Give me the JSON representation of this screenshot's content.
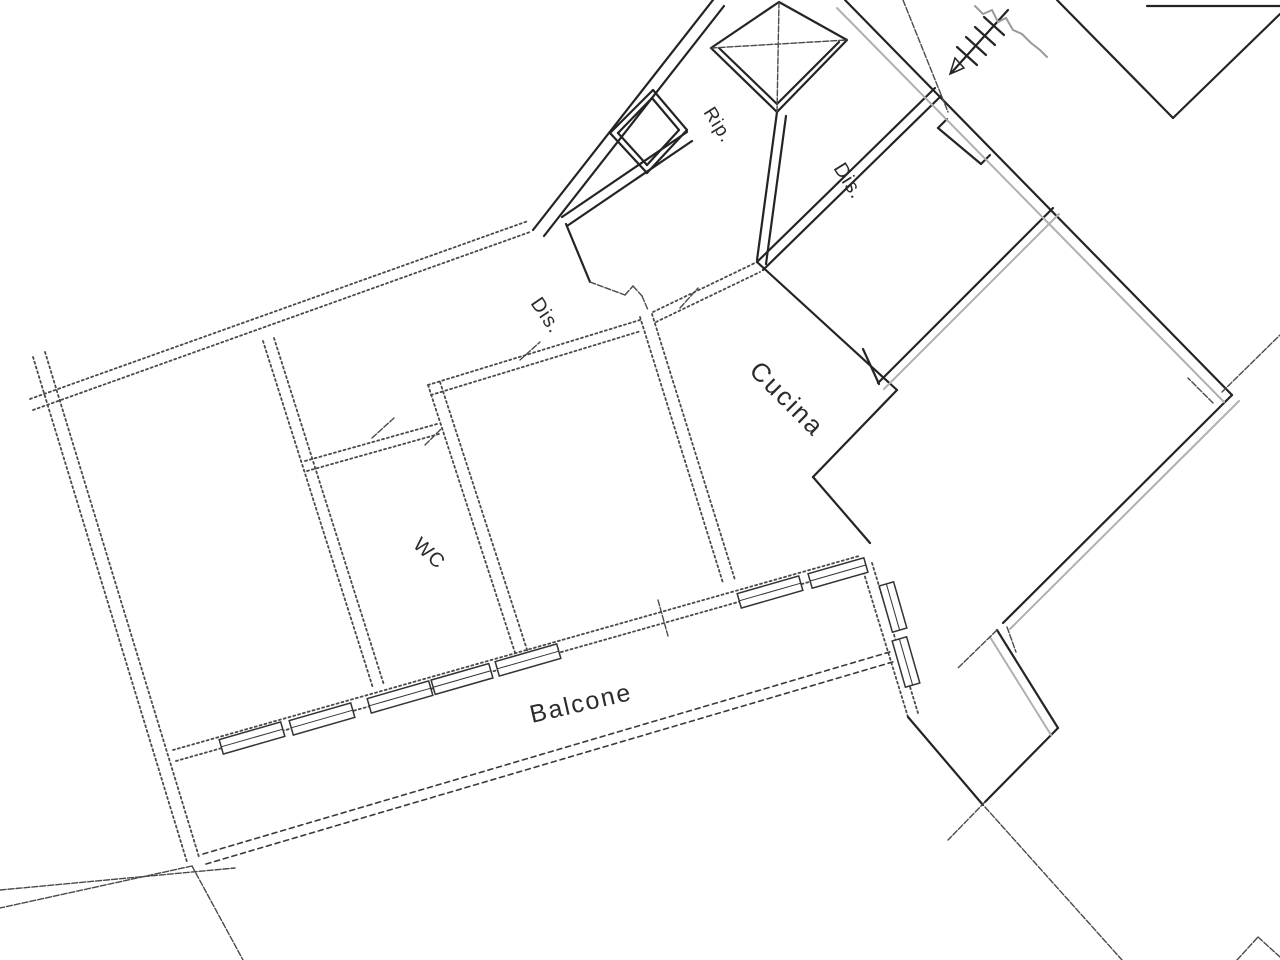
{
  "document": {
    "type": "scanned-floor-plan",
    "background_color": "#ffffff",
    "ink_color": "#242424",
    "faded_ink_color": "#4a4a4a",
    "gray_line_color": "#b0b0b0"
  },
  "labels": {
    "rip": {
      "text": "Rip.",
      "transform": "translate(703,112) rotate(58)"
    },
    "dis_landing": {
      "text": "Dis.",
      "transform": "translate(833,168) rotate(58)"
    },
    "dis_corridor": {
      "text": "Dis.",
      "transform": "translate(530,303) rotate(56)"
    },
    "cucina": {
      "text": "Cucina",
      "transform": "translate(748,372) rotate(45)"
    },
    "wc": {
      "text": "WC",
      "transform": "translate(412,546) rotate(43)"
    },
    "balcone": {
      "text": "Balcone",
      "transform": "translate(532,723) rotate(-13)"
    }
  },
  "segments": {
    "apartment-exterior-walls": {
      "style": "dashed",
      "lines": [
        [
          33,
          357,
          187,
          862
        ],
        [
          45,
          352,
          199,
          857
        ],
        [
          30,
          399,
          528,
          221
        ],
        [
          33,
          410,
          530,
          232
        ],
        [
          176,
          761,
          862,
          567
        ],
        [
          173,
          750,
          859,
          556
        ],
        [
          862,
          567,
          908,
          717
        ],
        [
          872,
          563,
          918,
          713
        ]
      ]
    },
    "apartment-partitions": {
      "style": "dashed",
      "lines": [
        [
          263,
          341,
          373,
          688
        ],
        [
          274,
          338,
          384,
          685
        ],
        [
          305,
          461,
          437,
          424
        ],
        [
          307,
          471,
          439,
          434
        ],
        [
          428,
          385,
          520,
          668
        ],
        [
          440,
          382,
          532,
          665
        ],
        [
          428,
          385,
          640,
          320
        ],
        [
          431,
          395,
          641,
          331
        ],
        [
          640,
          317,
          723,
          583
        ],
        [
          652,
          314,
          735,
          580
        ],
        [
          653,
          312,
          757,
          262
        ],
        [
          656,
          322,
          760,
          272
        ]
      ]
    },
    "balcony-parapet": {
      "style": "parapet",
      "lines": [
        [
          203,
          854,
          893,
          651
        ],
        [
          206,
          864,
          896,
          661
        ]
      ]
    },
    "party-walls": {
      "style": "crisp",
      "lines": [
        [
          845,
          0,
          1232,
          395
        ],
        [
          878,
          383,
          1053,
          208
        ],
        [
          1232,
          395,
          1003,
          623
        ],
        [
          863,
          349,
          879,
          384
        ],
        [
          935,
          88,
          757,
          262
        ],
        [
          941,
          96,
          763,
          270
        ],
        [
          757,
          262,
          897,
          390
        ],
        [
          897,
          390,
          813,
          477
        ],
        [
          813,
          477,
          870,
          543
        ],
        [
          1057,
          0,
          1173,
          118
        ],
        [
          1173,
          118,
          1280,
          14
        ],
        [
          1147,
          6,
          1280,
          6
        ],
        [
          997,
          630,
          1058,
          728
        ],
        [
          1058,
          728,
          985,
          802
        ],
        [
          908,
          717,
          983,
          805
        ],
        [
          713,
          0,
          533,
          230
        ],
        [
          724,
          6,
          544,
          236
        ],
        [
          687,
          132,
          562,
          217
        ],
        [
          692,
          141,
          567,
          226
        ],
        [
          566,
          224,
          590,
          282
        ],
        [
          777,
          112,
          757,
          260
        ],
        [
          786,
          116,
          766,
          264
        ],
        [
          938,
          128,
          981,
          164
        ],
        [
          938,
          128,
          947,
          119
        ],
        [
          981,
          164,
          990,
          155
        ]
      ]
    },
    "gray-double-lines": {
      "style": "gray",
      "lines": [
        [
          837,
          8,
          1224,
          402
        ],
        [
          1239,
          401,
          1010,
          629
        ],
        [
          884,
          389,
          1059,
          214
        ],
        [
          990,
          637,
          1051,
          735
        ]
      ]
    },
    "thin-lines": {
      "style": "thin",
      "lines": [
        [
          985,
          807,
          1122,
          960
        ],
        [
          0,
          890,
          235,
          868
        ],
        [
          192,
          866,
          243,
          960
        ],
        [
          192,
          866,
          0,
          908
        ],
        [
          1237,
          960,
          1258,
          937
        ],
        [
          1258,
          937,
          1280,
          957
        ],
        [
          1213,
          403,
          1188,
          378
        ],
        [
          1222,
          392,
          1280,
          335
        ],
        [
          985,
          802,
          948,
          840
        ],
        [
          997,
          630,
          958,
          668
        ],
        [
          1007,
          627,
          1016,
          652
        ],
        [
          658,
          600,
          668,
          636
        ],
        [
          372,
          438,
          394,
          418
        ],
        [
          520,
          360,
          540,
          342
        ],
        [
          680,
          308,
          698,
          288
        ],
        [
          425,
          445,
          442,
          428
        ],
        [
          903,
          0,
          948,
          112
        ],
        [
          590,
          282,
          625,
          295
        ],
        [
          625,
          295,
          633,
          286
        ],
        [
          633,
          286,
          642,
          296
        ],
        [
          642,
          296,
          648,
          310
        ]
      ]
    },
    "elevator-shaft-box": {
      "style": "crisp",
      "lines": [
        [
          779,
          2,
          711,
          48
        ],
        [
          711,
          48,
          777,
          112
        ],
        [
          777,
          112,
          847,
          40
        ],
        [
          847,
          40,
          779,
          2
        ],
        [
          719,
          48,
          777,
          104
        ],
        [
          777,
          104,
          839,
          42
        ]
      ]
    },
    "elevator-shaft-cross": {
      "style": "thin",
      "lines": [
        [
          779,
          2,
          777,
          112
        ],
        [
          711,
          48,
          847,
          40
        ]
      ]
    },
    "rip-duct-square": {
      "style": "crisp",
      "lines": [
        [
          610,
          133,
          653,
          90
        ],
        [
          653,
          90,
          687,
          130
        ],
        [
          687,
          130,
          647,
          173
        ],
        [
          647,
          173,
          610,
          133
        ],
        [
          618,
          133,
          652,
          98
        ],
        [
          652,
          98,
          679,
          130
        ],
        [
          679,
          130,
          647,
          165
        ],
        [
          647,
          165,
          618,
          133
        ]
      ]
    },
    "stair-arrow": {
      "style": "crisp",
      "lines": [
        [
          1008,
          10,
          952,
          72
        ],
        [
          984,
          17,
          1004,
          35
        ],
        [
          975,
          27,
          995,
          45
        ],
        [
          966,
          37,
          986,
          55
        ],
        [
          957,
          47,
          977,
          65
        ]
      ]
    }
  },
  "polylines": {
    "pencil-scribble": {
      "style": "scribble",
      "points": [
        [
          975,
          6
        ],
        [
          983,
          14
        ],
        [
          992,
          10
        ],
        [
          998,
          22
        ],
        [
          1006,
          18
        ],
        [
          1013,
          30
        ],
        [
          1022,
          34
        ],
        [
          1031,
          43
        ],
        [
          1040,
          50
        ],
        [
          1047,
          57
        ]
      ]
    }
  },
  "polygons": {
    "stair-arrowhead": {
      "style": "crispThin",
      "points": [
        [
          950,
          74
        ],
        [
          964,
          68
        ],
        [
          955,
          58
        ]
      ]
    }
  },
  "windows": {
    "balcony_wall_windows": [
      {
        "cx": 252,
        "cy": 738,
        "w": 64,
        "h": 15,
        "angle": -16
      },
      {
        "cx": 322,
        "cy": 719,
        "w": 64,
        "h": 15,
        "angle": -16
      },
      {
        "cx": 400,
        "cy": 697,
        "w": 64,
        "h": 15,
        "angle": -16
      },
      {
        "cx": 462,
        "cy": 679,
        "w": 60,
        "h": 15,
        "angle": -16
      },
      {
        "cx": 528,
        "cy": 660,
        "w": 64,
        "h": 15,
        "angle": -16
      },
      {
        "cx": 770,
        "cy": 592,
        "w": 64,
        "h": 15,
        "angle": -16
      },
      {
        "cx": 838,
        "cy": 573,
        "w": 58,
        "h": 15,
        "angle": -16
      },
      {
        "cx": 893,
        "cy": 607,
        "w": 15,
        "h": 48,
        "angle": -16
      },
      {
        "cx": 906,
        "cy": 662,
        "w": 15,
        "h": 48,
        "angle": -16
      }
    ]
  }
}
